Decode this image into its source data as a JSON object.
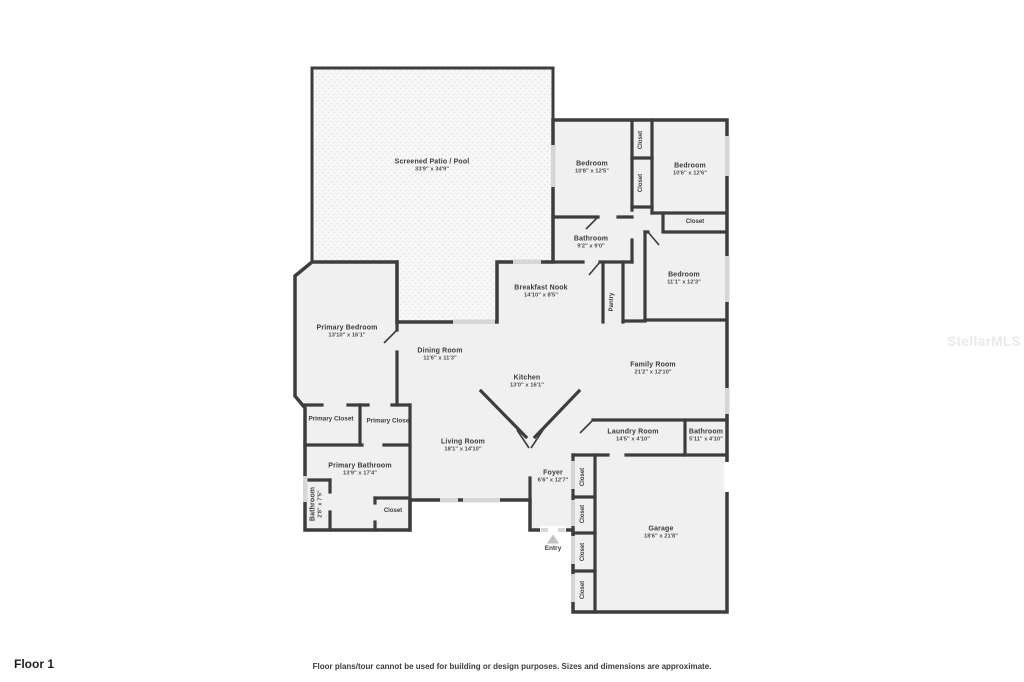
{
  "page": {
    "floor_label": "Floor 1",
    "disclaimer": "Floor plans/tour cannot be used for building or design purposes. Sizes and dimensions are approximate.",
    "watermark": "StellarMLS"
  },
  "colors": {
    "wall": "#3d3d3d",
    "room_fill": "#f0f0f0",
    "patio_fill": "#f7f7f7",
    "window": "#d6d6d6"
  },
  "entry": {
    "label": "Entry"
  },
  "rooms": [
    {
      "name": "Screened Patio / Pool",
      "dims": "33'9\" x 34'9\""
    },
    {
      "name": "Bedroom",
      "dims": "10'8\" x 12'5\""
    },
    {
      "name": "Bedroom",
      "dims": "10'6\" x 12'6\""
    },
    {
      "name": "Bathroom",
      "dims": "9'2\" x 9'0\""
    },
    {
      "name": "Bedroom",
      "dims": "11'1\" x 12'3\""
    },
    {
      "name": "Breakfast Nook",
      "dims": "14'10\" x 8'5\""
    },
    {
      "name": "Primary Bedroom",
      "dims": "13'10\" x 16'1\""
    },
    {
      "name": "Dining Room",
      "dims": "11'6\" x 11'3\""
    },
    {
      "name": "Kitchen",
      "dims": "13'0\" x 16'1\""
    },
    {
      "name": "Family Room",
      "dims": "21'2\" x 12'10\""
    },
    {
      "name": "Living Room",
      "dims": "18'1\" x 14'10\""
    },
    {
      "name": "Foyer",
      "dims": "6'6\" x 12'7\""
    },
    {
      "name": "Laundry Room",
      "dims": "14'5\" x 4'10\""
    },
    {
      "name": "Bathroom",
      "dims": "5'11\" x 4'10\""
    },
    {
      "name": "Garage",
      "dims": "18'6\" x 21'8\""
    },
    {
      "name": "Primary Bathroom",
      "dims": "13'9\" x 17'4\""
    },
    {
      "name": "Bathroom",
      "dims": "2'8\" x 7'5\""
    }
  ],
  "closets": [
    {
      "label": "Closet"
    },
    {
      "label": "Closet"
    },
    {
      "label": "Closet"
    },
    {
      "label": "Pantry"
    },
    {
      "label": "Primary Closet"
    },
    {
      "label": "Primary Closet"
    },
    {
      "label": "Closet"
    },
    {
      "label": "Closet"
    },
    {
      "label": "Closet"
    },
    {
      "label": "Closet"
    },
    {
      "label": "Closet"
    }
  ]
}
